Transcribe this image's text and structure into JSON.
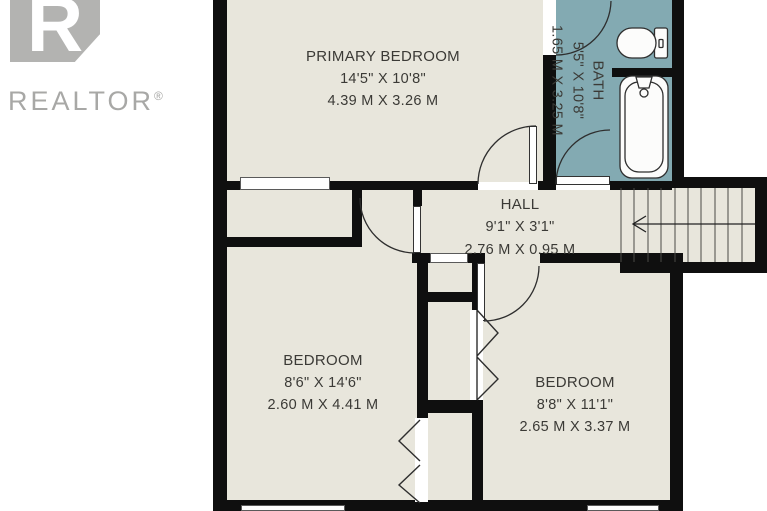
{
  "logo": {
    "letter": "R",
    "text": "REALTOR",
    "registered": "®"
  },
  "rooms": {
    "primary_bedroom": {
      "name": "PRIMARY BEDROOM",
      "imperial": "14'5\" X 10'8\"",
      "metric": "4.39 M X 3.26 M"
    },
    "bath": {
      "name": "BATH",
      "imperial": "5'5\" X 10'8\"",
      "metric": "1.65 M X 3.25 M"
    },
    "hall": {
      "name": "HALL",
      "imperial": "9'1\" X 3'1\"",
      "metric": "2.76 M X 0.95 M"
    },
    "bedroom_left": {
      "name": "BEDROOM",
      "imperial": "8'6\" X 14'6\"",
      "metric": "2.60 M X 4.41 M"
    },
    "bedroom_right": {
      "name": "BEDROOM",
      "imperial": "8'8\" X 11'1\"",
      "metric": "2.65 M X 3.37 M"
    }
  },
  "icons": {
    "toilet": "toilet-icon",
    "bathtub": "bathtub-icon",
    "stairs": "stairs-icon",
    "stairs_arrow": "stairs-direction-arrow",
    "bifold": "bifold-door-icon",
    "door_arc": "door-swing-arc"
  },
  "colors": {
    "wall": "#0f0f0f",
    "room_fill": "#e8e6dc",
    "bath_fill": "#83aab2",
    "outside": "#ffffff",
    "line": "#2e2e2e",
    "label_text": "#3b3a36",
    "logo_gray": "#b3b3b1",
    "logo_text": "#a8a8a6"
  }
}
